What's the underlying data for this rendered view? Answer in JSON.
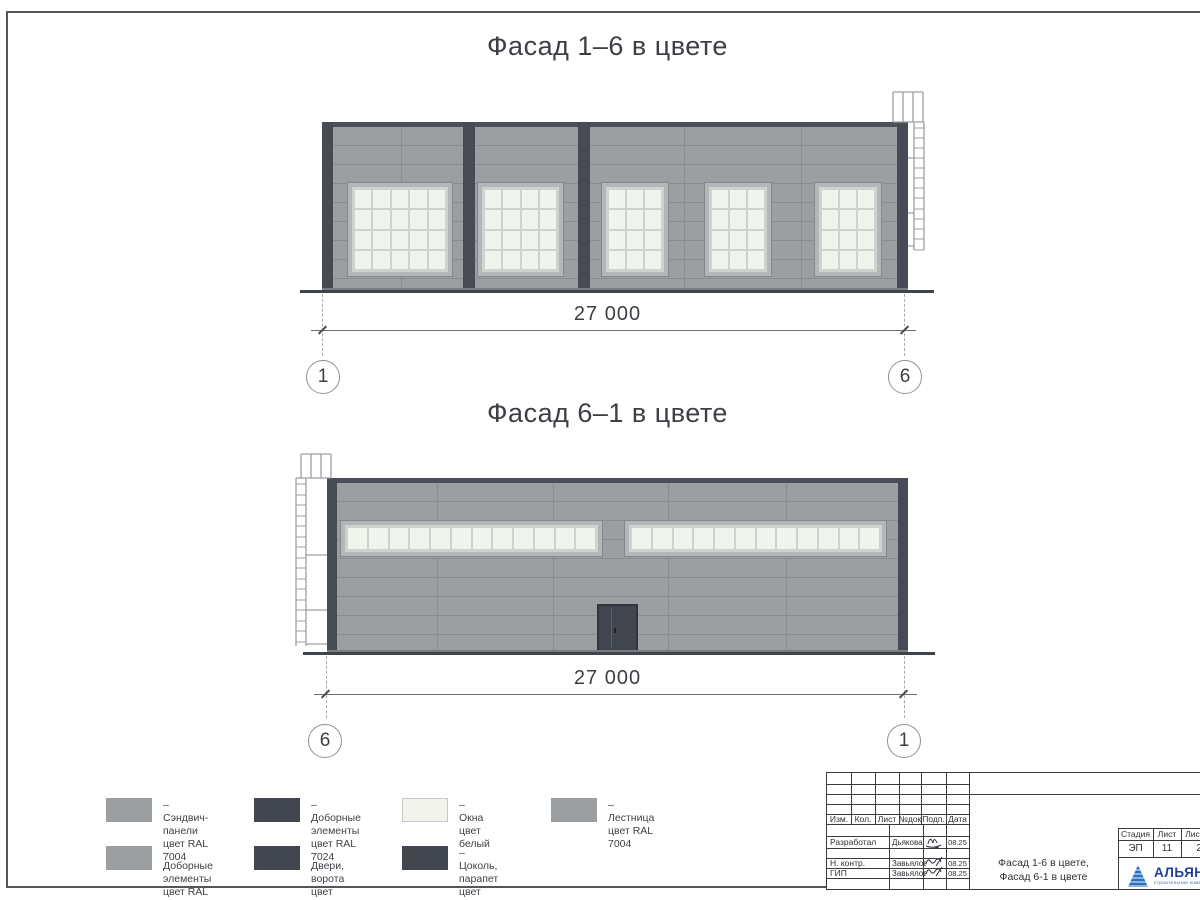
{
  "sheet": {
    "titles": {
      "facade1": "Фасад 1–6 в цвете",
      "facade2": "Фасад 6–1 в цвете"
    }
  },
  "facade1": {
    "dimension": "27 000",
    "axis_left": "1",
    "axis_right": "6",
    "window_rows": 4,
    "windows": [
      {
        "cols": 5
      },
      {
        "cols": 4
      },
      {
        "cols": 3
      },
      {
        "cols": 3
      },
      {
        "cols": 3
      }
    ]
  },
  "facade2": {
    "dimension": "27 000",
    "axis_left": "6",
    "axis_right": "1",
    "ribbon_panes": 12
  },
  "legend": {
    "items": [
      {
        "swatch": "#9c9fa2",
        "line1": "– Сэндвич-панели",
        "line2": "цвет RAL 7004"
      },
      {
        "swatch": "#42464e",
        "line1": "– Доборные элементы",
        "line2": "цвет RAL 7024"
      },
      {
        "swatch": "#f2f4ec",
        "line1": "– Окна",
        "line2": "цвет белый"
      },
      {
        "swatch": "#9c9fa2",
        "line1": "– Лестница",
        "line2": "цвет RAL 7004"
      },
      {
        "swatch": "#9c9fa2",
        "line1": "– Доборные элементы",
        "line2": "цвет RAL 7004"
      },
      {
        "swatch": "#42464e",
        "line1": "– Двери, ворота",
        "line2": "цвет RAL 7024"
      },
      {
        "swatch": "#42464e",
        "line1": "– Цоколь, парапет",
        "line2": "цвет RAL 7024"
      }
    ]
  },
  "titleblock": {
    "header_cols": [
      "Изм.",
      "Кол.",
      "Лист",
      "№док",
      "Подп.",
      "Дата"
    ],
    "sign_rows": [
      {
        "role": "Разработал",
        "name": "Дьякова",
        "date": "08.25"
      },
      {
        "role": "Н. контр.",
        "name": "Завьялова",
        "date": "08.25"
      },
      {
        "role": "ГИП",
        "name": "Завьялова",
        "date": "08.25"
      }
    ],
    "doc_name_line1": "Фасад 1-6 в цвете,",
    "doc_name_line2": "Фасад 6-1 в цвете",
    "stage_headers": [
      "Стадия",
      "Лист",
      "Листов"
    ],
    "stage_values": [
      "ЭП",
      "11",
      "2"
    ],
    "logo_name": "АЛЬЯНС",
    "logo_tagline": "строительная компания"
  },
  "colors": {
    "sandwich_panel_ral7004": "#9c9fa2",
    "dark_elements_ral7024": "#474b53",
    "window_white": "#f1f4ed",
    "ground": "#3f434a",
    "logo_blue": "#2e6fc0",
    "logo_text_blue": "#203f9a"
  }
}
